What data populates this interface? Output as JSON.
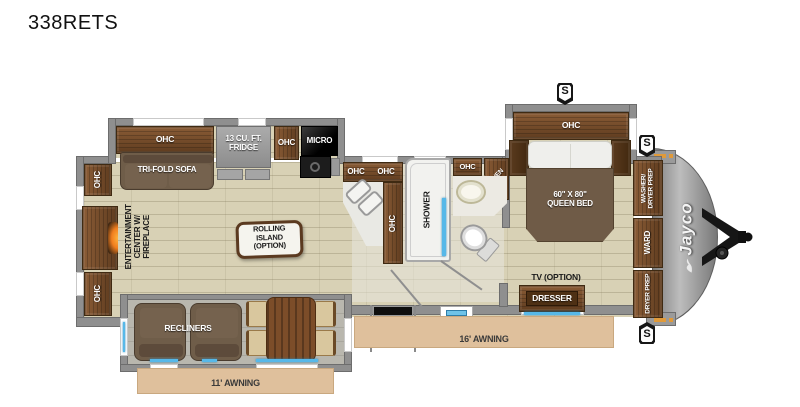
{
  "title": "338RETS",
  "labels": {
    "ohc": "OHC",
    "tri_fold_sofa": "TRI-FOLD SOFA",
    "fridge_lines": [
      "13 CU. FT.",
      "FRIDGE"
    ],
    "micro": "MICRO",
    "shower": "SHOWER",
    "linen": "LINEN",
    "queen_bed_lines": [
      "60\" X 80\"",
      "QUEEN BED"
    ],
    "entertainment_lines": [
      "ENTERTAINMENT",
      "CENTER W/",
      "FIREPLACE"
    ],
    "island_lines": [
      "ROLLING",
      "ISLAND",
      "(OPTION)"
    ],
    "washer_dryer_lines": [
      "WASHER/",
      "DRYER PREP"
    ],
    "ward": "WARD",
    "dryer_prep": "DRYER PREP",
    "tv_option": "TV (OPTION)",
    "dresser": "DRESSER",
    "recliners": "RECLINERS",
    "awning_16": "16' AWNING",
    "awning_11": "11' AWNING",
    "brand": "Jayco",
    "speaker": "S"
  },
  "colors": {
    "wood": "#6b4527",
    "floor_tile": "#d8d1b5",
    "wall_gray": "#8f8f8f",
    "awning_tan": "#dfc09c",
    "accent_blue": "#57b8e8",
    "fireplace_glow": "#ff9d2e",
    "upholstery": "#6f5d49"
  }
}
